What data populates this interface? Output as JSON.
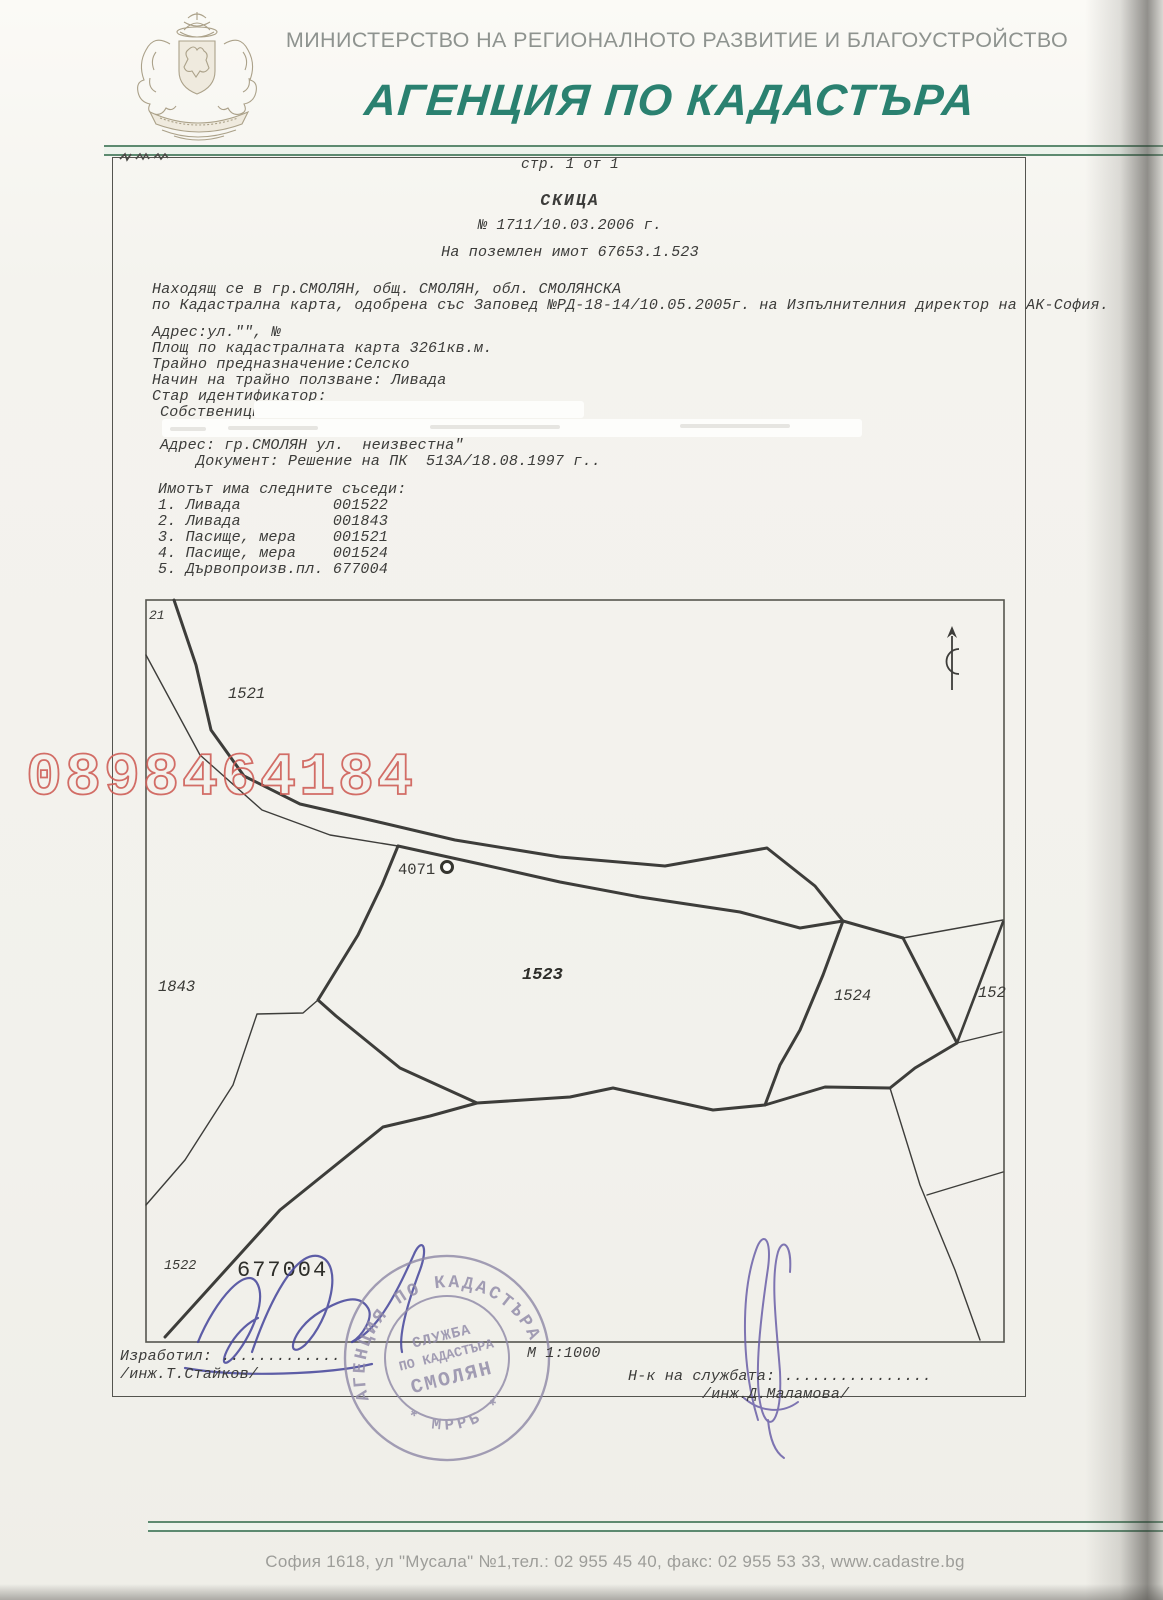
{
  "header": {
    "ministry": "МИНИСТЕРСТВО НА РЕГИОНАЛНОТО РАЗВИТИЕ И БЛАГОУСТРОЙСТВО",
    "agency": "АГЕНЦИЯ ПО КАДАСТЪРА",
    "agency_color": "#2a8170",
    "ministry_color": "#8e938f"
  },
  "document": {
    "page_label": "стр. 1 от 1",
    "title": "СКИЦА",
    "number_line": "№ 1711/10.03.2006 г.",
    "subject_line": "На поземлен имот 67653.1.523",
    "location_line1": "Находящ се в гр.СМОЛЯН, общ. СМОЛЯН, обл. СМОЛЯНСКА",
    "location_line2": "по Кадастрална карта, одобрена със Заповед №РД-18-14/10.05.2005г. на Изпълнителния директор на АК-София.",
    "address_line": "Адрес:ул.\"\", №",
    "area_line": "Площ по кадастралната карта 3261кв.м.",
    "purpose_line": "Трайно предназначение:Селско",
    "usage_line": "Начин на трайно ползване: Ливада",
    "old_id_line": "Стар идентификатор:",
    "owners_label": "Собственици:",
    "owner_address_line": "Адрес: гр.СМОЛЯН ул.  неизвестна\"",
    "owner_document_line": "Документ: Решение на ПК  513А/18.08.1997 г..",
    "neighbors_heading": "Имотът има следните съседи:",
    "neighbors": [
      {
        "text": "1. Ливада          001522"
      },
      {
        "text": "2. Ливада          001843"
      },
      {
        "text": "3. Пасище, мера    001521"
      },
      {
        "text": "4. Пасище, мера    001524"
      },
      {
        "text": "5. Дървопроизв.пл. 677004"
      }
    ]
  },
  "map": {
    "labels": {
      "p21": "21",
      "p1521": "1521",
      "p1843": "1843",
      "p1523": "1523",
      "p1524": "1524",
      "p152": "152",
      "p1522": "1522",
      "p677004": "677004",
      "point4071": "4071"
    },
    "scale": "М 1:1000"
  },
  "signoff": {
    "prepared_by_label": "Изработил: .............",
    "prepared_by_name": "/инж.Т.Стайков/",
    "chief_label": "Н-к на службата: ................",
    "chief_name": "/инж.Д.Маламова/"
  },
  "stamp": {
    "ring_top": "АГЕНЦИЯ ПО КАДАСТЪРА",
    "ring_bottom": "*  МРРБ  *",
    "inner_line1": "СЛУЖБА",
    "inner_line2": "ПО КАДАСТЪРА",
    "inner_line3": "СМОЛЯН",
    "color": "#8e88a6"
  },
  "watermark": {
    "text": "0898464184",
    "color": "#cf5f58"
  },
  "footer": {
    "text": "София 1618, ул \"Мусала\" №1,тел.: 02 955 45 40,  факс:  02 955 53 33, www.cadastre.bg"
  }
}
